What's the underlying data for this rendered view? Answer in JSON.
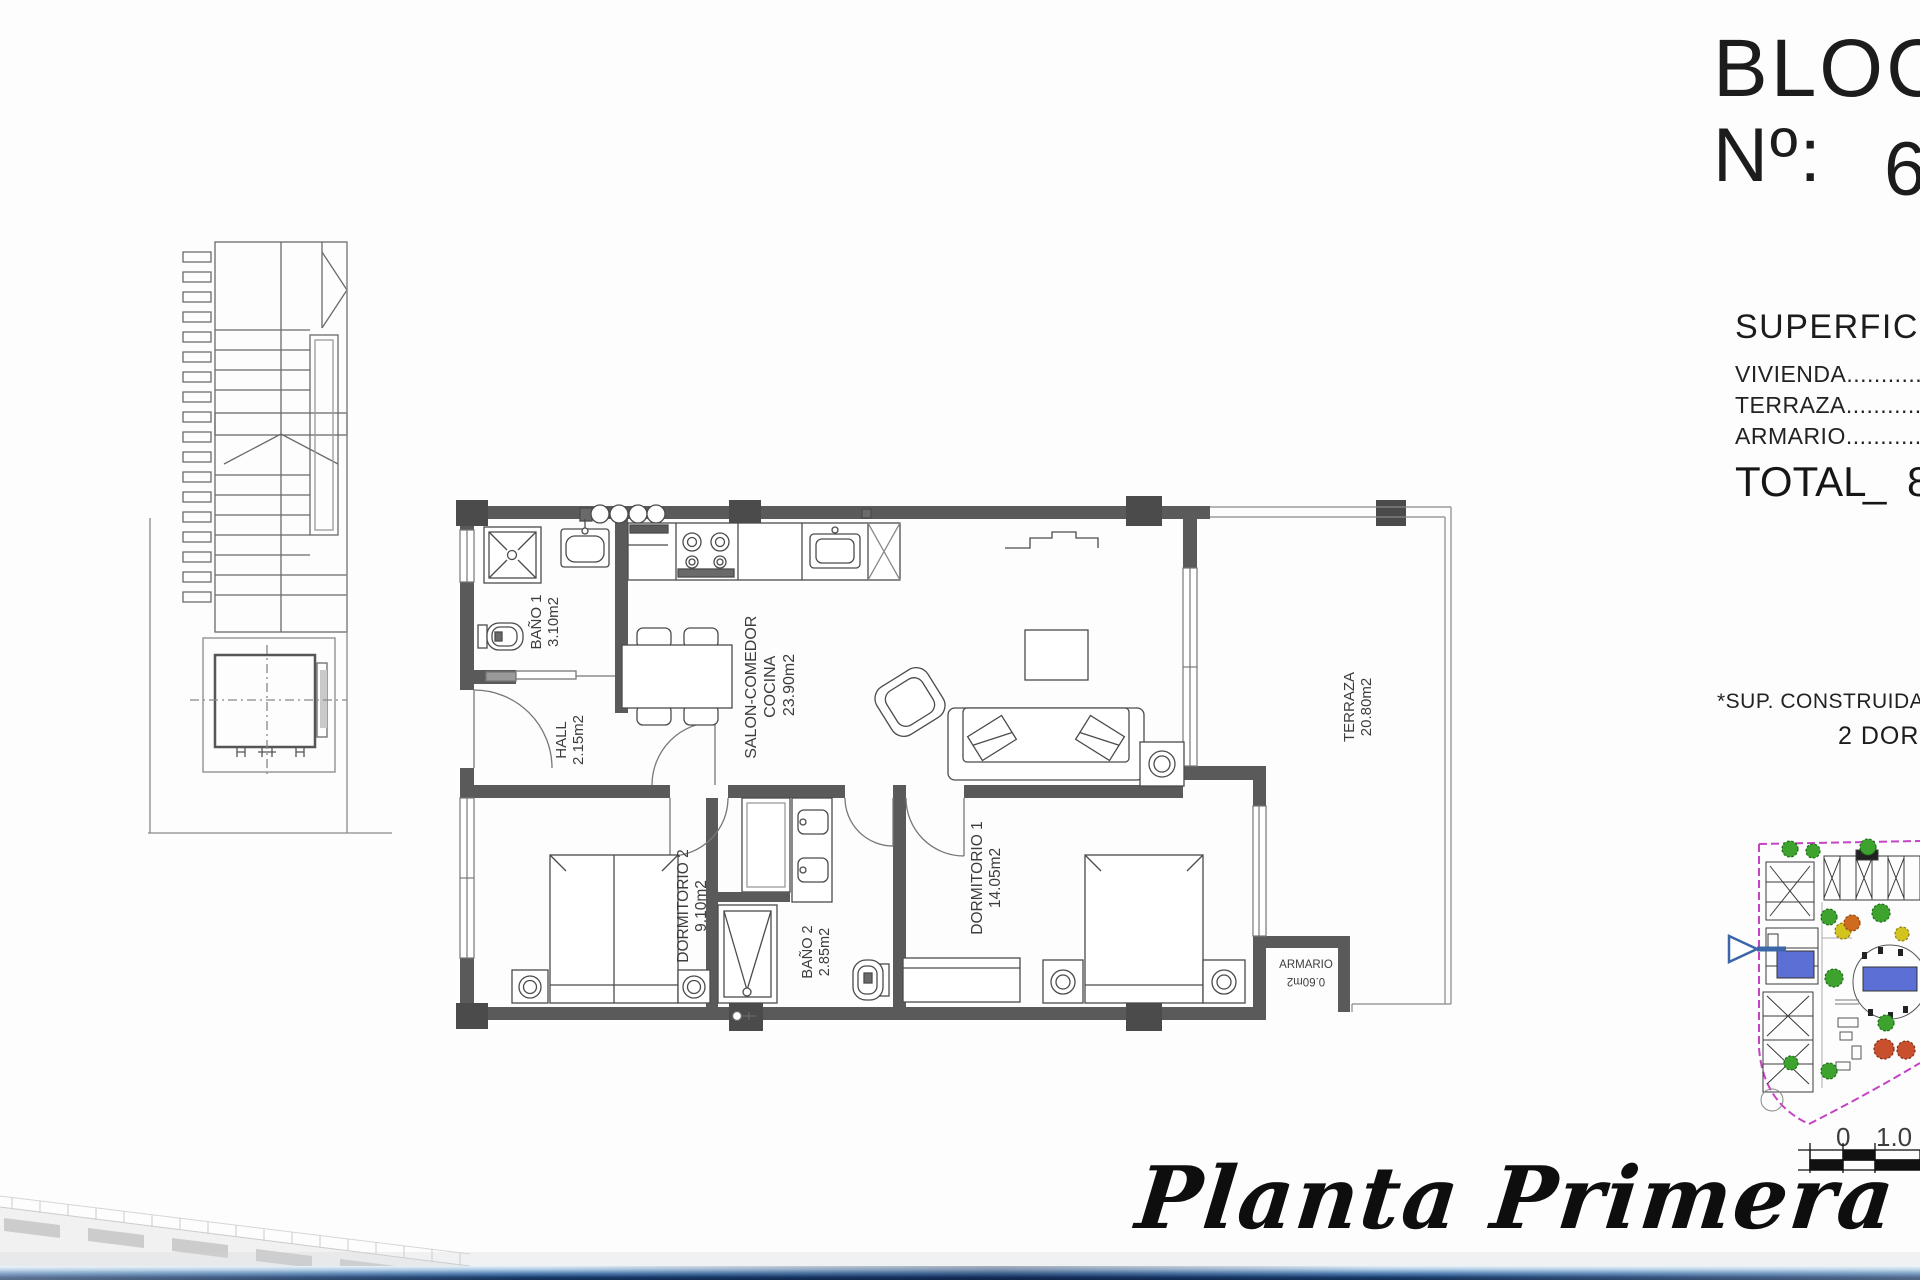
{
  "header": {
    "block_word": "BLOC",
    "unit_label": "Nº:",
    "unit_number": "6"
  },
  "surfaces": {
    "heading": "SUPERFICIE",
    "vivienda": "VIVIENDA..............................",
    "terraza": "TERRAZA..............................",
    "armario": "ARMARIO..............................",
    "total_label": "TOTAL",
    "total_separator": "_",
    "total_value": "8"
  },
  "notes": {
    "constructed": "*SUP. CONSTRUIDAS",
    "bedrooms": "2 DORM"
  },
  "rooms": {
    "bano1": {
      "name": "BAÑO 1",
      "area": "3.10m2"
    },
    "hall": {
      "name": "HALL",
      "area": "2.15m2"
    },
    "salon": {
      "name_line1": "SALON-COMEDOR",
      "name_line2": "COCINA",
      "area": "23.90m2"
    },
    "dormitorio2": {
      "name": "DORMITORIO 2",
      "area": "9.10m2"
    },
    "bano2": {
      "name": "BAÑO 2",
      "area": "2.85m2"
    },
    "dormitorio1": {
      "name": "DORMITORIO 1",
      "area": "14.05m2"
    },
    "armario": {
      "name": "ARMARIO",
      "area": "0.60m2"
    },
    "terraza": {
      "name": "TERRAZA",
      "area": "20.80m2"
    }
  },
  "titles": {
    "plan_name": "Planta Primera"
  },
  "scalebar": {
    "zero": "0",
    "meter": "1.0 m."
  },
  "colors": {
    "wall": "#5a5a5a",
    "boundary_magenta": "#c643c6",
    "pool_blue": "#5b6fd4",
    "arrow_blue": "#3c66a8",
    "tree_green": "#3da32e",
    "tree_yellow": "#d2c31f",
    "tree_orange": "#cf6b1e",
    "tree_red": "#c8502e"
  }
}
